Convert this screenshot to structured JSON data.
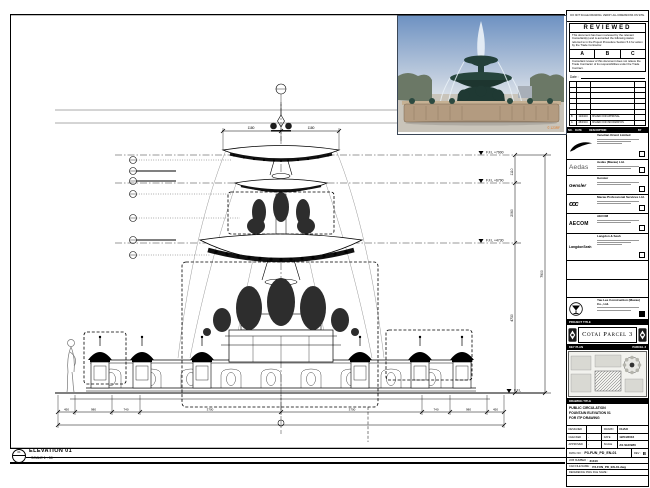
{
  "sheet": {
    "top_note": "DO NOT SCALE DRAWING. VERIFY ALL DIMENSIONS ON SITE."
  },
  "photo": {
    "watermark": "© 123RF"
  },
  "stamp": {
    "title": "REVIEWED",
    "para1": "This document has been reviewed by the relevant Consultant(s) and is accorded the following status referred to in the Project Procedure Section 5.4 for action by the Trade Contractor.",
    "grade_a": "A",
    "grade_b": "B",
    "grade_c": "C",
    "para2": "Consultant review of this document does not relieve the Trade Contractor of its responsibilities under the Trade Contract.",
    "date_label": "Date :",
    "rows": [
      {
        "rev": "B",
        "date": "12/04/16",
        "desc": "ISSUED FOR APPROVAL",
        "by": ""
      },
      {
        "rev": "A",
        "date": "28/03/16",
        "desc": "ISSUED FOR INFORMATION",
        "by": ""
      }
    ],
    "header": {
      "no": "NO.",
      "date": "DATE",
      "description": "DESCRIPTION",
      "by": "BY"
    }
  },
  "titleblock": {
    "consultants": [
      {
        "logo_text": "",
        "name": "Venetian Orient Limited"
      },
      {
        "logo_text": "Aedas",
        "name": "Aedas (Macau) Ltd."
      },
      {
        "logo_text": "Gensler",
        "name": "Gensler"
      },
      {
        "logo_text": "ccc",
        "name": "Macau Professional Services Ltd."
      },
      {
        "logo_text": "AECOM",
        "name": "AECOM"
      },
      {
        "logo_text": "LangdonSeah",
        "name": "Langdon & Seah"
      }
    ],
    "contractor": {
      "name": "Yau Lee Construction (Macau) Co., Ltd."
    },
    "project_title_label": "PROJECT TITLE",
    "project_title": "Cotai Parcel 3",
    "key_plan_label": "KEY PLAN",
    "key_plan_note": "PARCEL 3",
    "drawing_title_label": "DRAWING TITLE",
    "title_line1": "PUBLIC CIRCULATION",
    "title_line2": "FOUNTAIN ELEVATION 01",
    "title_line3": "FOR ITP DRAWING",
    "fields": {
      "designed_label": "DESIGNED",
      "designed": "",
      "drawn_label": "DRAWN",
      "drawn": "CHAO",
      "checked_label": "CHECKED",
      "checked": "-",
      "date_label": "DATE",
      "date": "12/04/2016",
      "approved_label": "APPROVED",
      "approved": "-",
      "scale_label": "SCALE",
      "scale": "AS SHOWN",
      "dwg_label": "DWG NO :",
      "dwg_no": "P3-FUN_PD_EN-01",
      "rev_label": "REV :",
      "rev": "B",
      "job_label": "JOB NUMBER :",
      "job": "31310",
      "file_label": "CAD FILE NAME :",
      "file": "P3-FUN_PD_EN-01.dwg",
      "ref_label": "REFERENCE DWG FILE NAME :"
    }
  },
  "drawing": {
    "elevation_num": "01",
    "elevation_title": "ELEVATION 01",
    "elevation_scale": "SCALE  1 : 50",
    "levels": {
      "l1": "F.F.L +7900",
      "l2": "F.F.L +6790",
      "l3": "F.F.L +4730",
      "l4": "F.F.L"
    },
    "vdims": {
      "d1": "1110",
      "d2": "2060",
      "d3": "4730",
      "d4": "7900"
    },
    "top_dims": {
      "t1": "1180",
      "t2": "1180"
    },
    "bottom_dims": {
      "b1": "450",
      "b2": "980",
      "b3": "740",
      "b4": "3700",
      "b5": "3700",
      "b6": "740",
      "b7": "980",
      "b8": "450"
    }
  }
}
